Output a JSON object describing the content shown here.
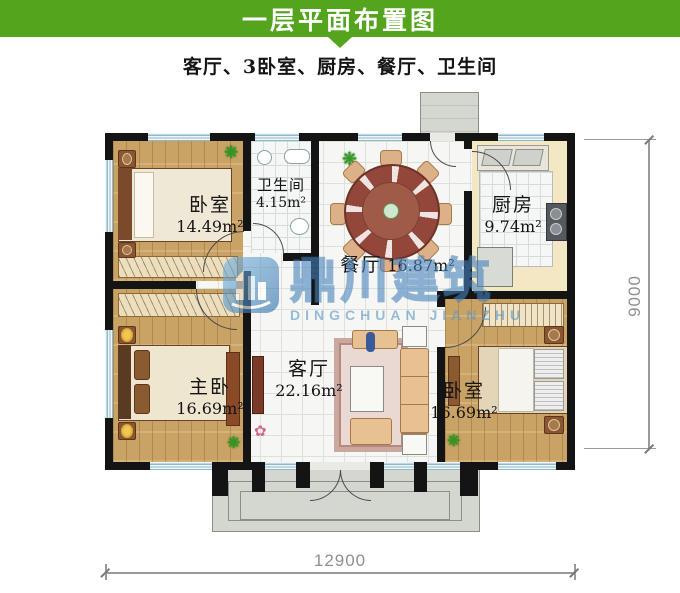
{
  "header": {
    "title": "一层平面布置图",
    "subtitle": "客厅、3卧室、厨房、餐厅、卫生间"
  },
  "rooms": {
    "bedroom1": {
      "name": "卧室",
      "area": "14.49m²"
    },
    "bathroom": {
      "name": "卫生间",
      "area": "4.15m²"
    },
    "dining": {
      "name": "餐厅",
      "area": "16.87m²"
    },
    "kitchen": {
      "name": "厨房",
      "area": "9.74m²"
    },
    "master": {
      "name": "主卧",
      "area": "16.69m²"
    },
    "living": {
      "name": "客厅",
      "area": "22.16m²"
    },
    "bedroom2": {
      "name": "卧室",
      "area": "16.69m²"
    }
  },
  "watermark": {
    "name_cn": "鼎川建筑",
    "name_en": "DINGCHUAN JIANZHU"
  },
  "dimensions": {
    "width": "12900",
    "height": "9000"
  },
  "icons": {
    "plant": "❋",
    "flower": "✿"
  },
  "colors": {
    "accent_green": "#55a41e",
    "wall": "#141414",
    "wood_floor": "#c9a365",
    "kitchen_floor": "#f4e7c3",
    "window": "#cfe4ec",
    "watermark_blue": "#4f92c8"
  }
}
